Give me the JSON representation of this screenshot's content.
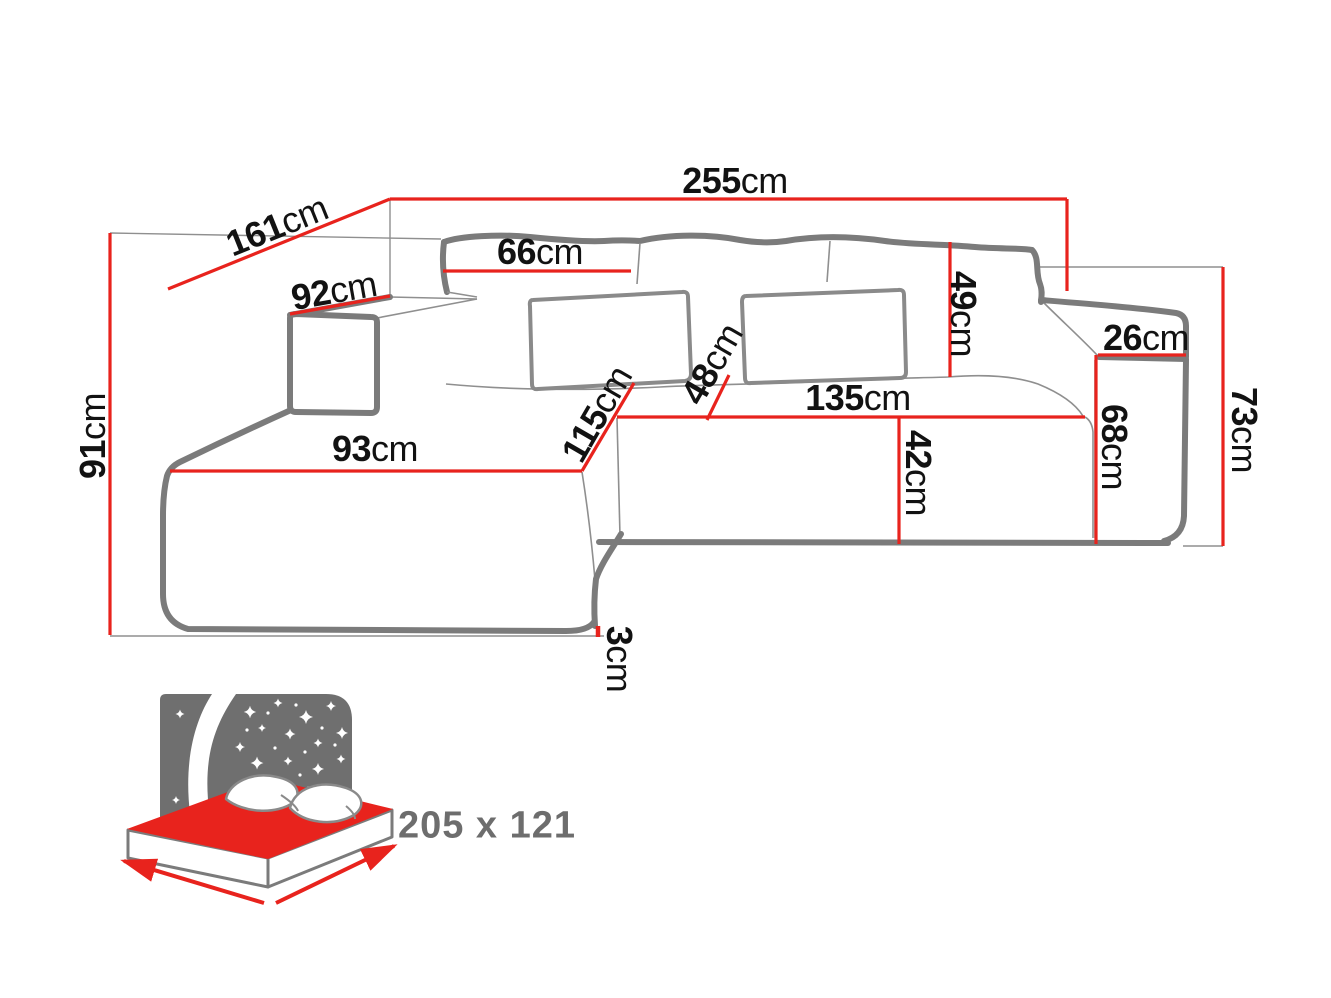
{
  "colors": {
    "accent_red": "#e8231d",
    "outline_gray": "#7b7b7b",
    "thin_gray": "#8f8f8f",
    "text_black": "#121212",
    "bed_label_gray": "#6d6d6d"
  },
  "dimensions": {
    "overall_width": {
      "value": "255",
      "unit": "cm"
    },
    "left_depth": {
      "value": "161",
      "unit": "cm"
    },
    "left_height": {
      "value": "91",
      "unit": "cm"
    },
    "left_armrest_top_width": {
      "value": "92",
      "unit": "cm"
    },
    "back_cushion_width": {
      "value": "66",
      "unit": "cm"
    },
    "back_pillow_height": {
      "value": "49",
      "unit": "cm"
    },
    "right_armrest_top_width": {
      "value": "26",
      "unit": "cm"
    },
    "right_side_height": {
      "value": "73",
      "unit": "cm"
    },
    "right_armrest_front_height": {
      "value": "68",
      "unit": "cm"
    },
    "chaise_front_width": {
      "value": "93",
      "unit": "cm"
    },
    "chaise_depth": {
      "value": "115",
      "unit": "cm"
    },
    "seat_depth": {
      "value": "48",
      "unit": "cm"
    },
    "seat_width": {
      "value": "135",
      "unit": "cm"
    },
    "seat_front_height": {
      "value": "42",
      "unit": "cm"
    },
    "feet_height": {
      "value": "3",
      "unit": "cm"
    }
  },
  "sleeping_area": {
    "label": "205 x 121",
    "icon": "sofa-bed-sleeping-function-icon"
  }
}
